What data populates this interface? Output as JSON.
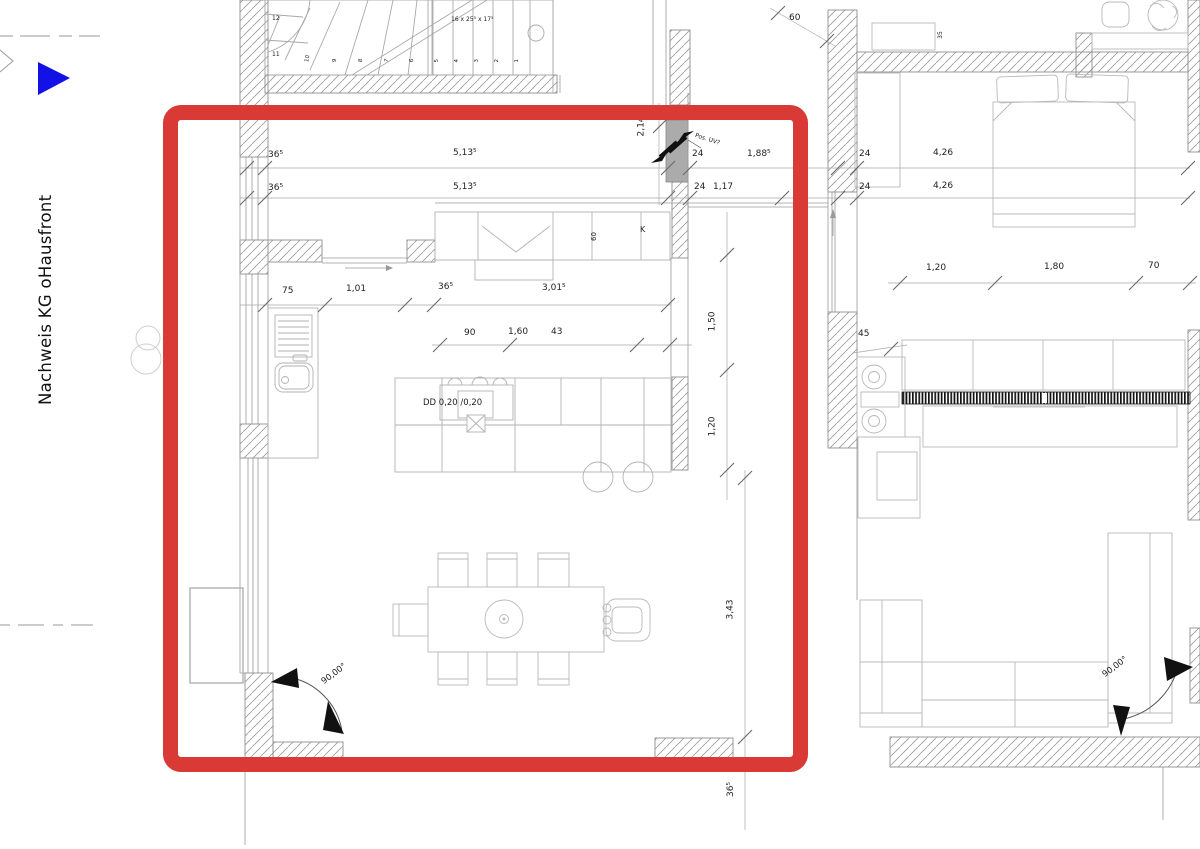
{
  "colors": {
    "highlight_red": "#d93a35",
    "marker_blue": "#1212e6",
    "column_gray": "#ababab"
  },
  "margin": {
    "side_label": "Nachweis KG oHausfront"
  },
  "stairs": {
    "formula": "16 x 25⁵ x 17⁵",
    "numbers": [
      "12",
      "11",
      "10",
      "9",
      "8",
      "7",
      "6",
      "5",
      "4",
      "3",
      "2",
      "1"
    ]
  },
  "kitchen": {
    "dims_row1": [
      "36⁵",
      "5,13⁵",
      "24",
      "1,88⁵"
    ],
    "dims_row2": [
      "36⁵",
      "5,13⁵",
      "24",
      "1,17",
      "7¹"
    ],
    "dims_mid": [
      "75",
      "1,01",
      "36⁵",
      "3,01⁵"
    ],
    "dims_island": [
      "90",
      "1,60",
      "43"
    ],
    "dim_right_upper": "1,50",
    "dim_right_lower": "1,20",
    "dim_vert_low": "3,43",
    "dim_below_frame": "36⁵",
    "dim_stairwell": "2,14",
    "cooktop_label": "DD 0,20 /0,20",
    "cabinet_depth_label": "60",
    "column_label": "K",
    "electrical_label": "Pos. UV?",
    "angle_label": "90,00°"
  },
  "bedroom": {
    "dim_top": "60",
    "dim_wall_small": "35",
    "dims_row1": [
      "24",
      "4,26"
    ],
    "dims_row2": [
      "24",
      "4,26"
    ],
    "dims_closet": [
      "1,20",
      "1,80",
      "70"
    ],
    "dim_cabinet": "45",
    "angle_label": "90,00°"
  }
}
